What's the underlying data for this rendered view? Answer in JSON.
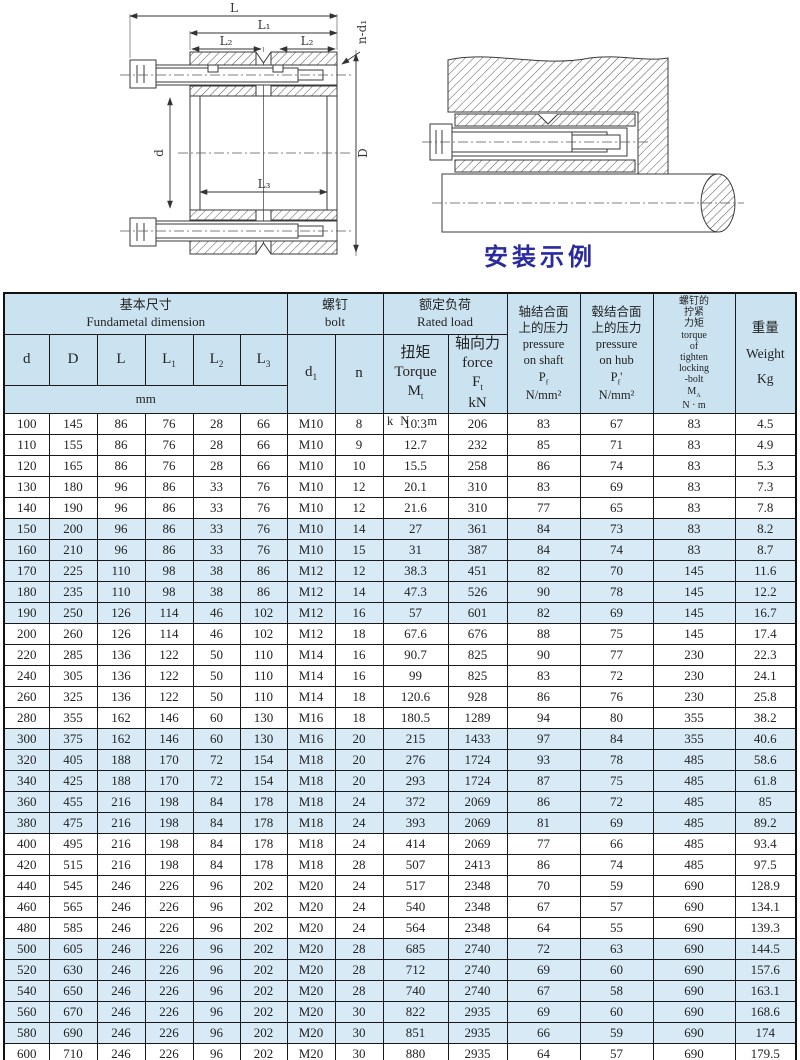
{
  "caption": "安装示例",
  "drawings": {
    "left": {
      "dim_L": "L",
      "dim_L1": "L₁",
      "dim_L2a": "L₂",
      "dim_L2b": "L₂",
      "dim_L3": "L₃",
      "dim_d": "d",
      "dim_D": "D",
      "dim_nd1": "n-d₁"
    }
  },
  "table": {
    "header": {
      "basic": "基本尺寸\nFundametal  dimension",
      "bolt": "螺钉\nbolt",
      "rated": "额定负荷\nRated load",
      "col_d": "d",
      "col_D": "D",
      "col_L": "L",
      "col_L1": "L~1~",
      "col_L2": "L~2~",
      "col_L3": "L~3~",
      "unit_mm": "mm",
      "col_d1": "d~1~",
      "col_n": "n",
      "torque_lines": "扭矩\nTorque\nM~t~",
      "torque_unit": "kN·m",
      "force": "轴向力\nforce\nF~t~\nkN",
      "pressure_shaft": "轴结合面\n上的压力\npressure\non shaft\nP~f~\nN/mm²",
      "pressure_hub": "毂结合面\n上的压力\npressure\non hub\nP~f~'\nN/mm²",
      "ma": "螺钉的\n拧紧\n力矩\ntorque\nof\ntighten\nlocking\n-bolt\nM~A~\nN · m",
      "weight": "重量\nWeight\nKg"
    },
    "rows": [
      [
        100,
        145,
        86,
        76,
        28,
        66,
        "M10",
        8,
        10.3,
        206,
        83,
        67,
        83,
        4.5
      ],
      [
        110,
        155,
        86,
        76,
        28,
        66,
        "M10",
        9,
        12.7,
        232,
        85,
        71,
        83,
        4.9
      ],
      [
        120,
        165,
        86,
        76,
        28,
        66,
        "M10",
        10,
        15.5,
        258,
        86,
        74,
        83,
        5.3
      ],
      [
        130,
        180,
        96,
        86,
        33,
        76,
        "M10",
        12,
        20.1,
        310,
        83,
        69,
        83,
        7.3
      ],
      [
        140,
        190,
        96,
        86,
        33,
        76,
        "M10",
        12,
        21.6,
        310,
        77,
        65,
        83,
        7.8
      ],
      [
        150,
        200,
        96,
        86,
        33,
        76,
        "M10",
        14,
        27,
        361,
        84,
        73,
        83,
        8.2
      ],
      [
        160,
        210,
        96,
        86,
        33,
        76,
        "M10",
        15,
        31,
        387,
        84,
        74,
        83,
        8.7
      ],
      [
        170,
        225,
        110,
        98,
        38,
        86,
        "M12",
        12,
        38.3,
        451,
        82,
        70,
        145,
        11.6
      ],
      [
        180,
        235,
        110,
        98,
        38,
        86,
        "M12",
        14,
        47.3,
        526,
        90,
        78,
        145,
        12.2
      ],
      [
        190,
        250,
        126,
        114,
        46,
        102,
        "M12",
        16,
        57,
        601,
        82,
        69,
        145,
        16.7
      ],
      [
        200,
        260,
        126,
        114,
        46,
        102,
        "M12",
        18,
        67.6,
        676,
        88,
        75,
        145,
        17.4
      ],
      [
        220,
        285,
        136,
        122,
        50,
        110,
        "M14",
        16,
        90.7,
        825,
        90,
        77,
        230,
        22.3
      ],
      [
        240,
        305,
        136,
        122,
        50,
        110,
        "M14",
        16,
        99,
        825,
        83,
        72,
        230,
        24.1
      ],
      [
        260,
        325,
        136,
        122,
        50,
        110,
        "M14",
        18,
        120.6,
        928,
        86,
        76,
        230,
        25.8
      ],
      [
        280,
        355,
        162,
        146,
        60,
        130,
        "M16",
        18,
        180.5,
        1289,
        94,
        80,
        355,
        38.2
      ],
      [
        300,
        375,
        162,
        146,
        60,
        130,
        "M16",
        20,
        215,
        1433,
        97,
        84,
        355,
        40.6
      ],
      [
        320,
        405,
        188,
        170,
        72,
        154,
        "M18",
        20,
        276,
        1724,
        93,
        78,
        485,
        58.6
      ],
      [
        340,
        425,
        188,
        170,
        72,
        154,
        "M18",
        20,
        293,
        1724,
        87,
        75,
        485,
        61.8
      ],
      [
        360,
        455,
        216,
        198,
        84,
        178,
        "M18",
        24,
        372,
        2069,
        86,
        72,
        485,
        85
      ],
      [
        380,
        475,
        216,
        198,
        84,
        178,
        "M18",
        24,
        393,
        2069,
        81,
        69,
        485,
        89.2
      ],
      [
        400,
        495,
        216,
        198,
        84,
        178,
        "M18",
        24,
        414,
        2069,
        77,
        66,
        485,
        93.4
      ],
      [
        420,
        515,
        216,
        198,
        84,
        178,
        "M18",
        28,
        507,
        2413,
        86,
        74,
        485,
        97.5
      ],
      [
        440,
        545,
        246,
        226,
        96,
        202,
        "M20",
        24,
        517,
        2348,
        70,
        59,
        690,
        128.9
      ],
      [
        460,
        565,
        246,
        226,
        96,
        202,
        "M20",
        24,
        540,
        2348,
        67,
        57,
        690,
        134.1
      ],
      [
        480,
        585,
        246,
        226,
        96,
        202,
        "M20",
        24,
        564,
        2348,
        64,
        55,
        690,
        139.3
      ],
      [
        500,
        605,
        246,
        226,
        96,
        202,
        "M20",
        28,
        685,
        2740,
        72,
        63,
        690,
        144.5
      ],
      [
        520,
        630,
        246,
        226,
        96,
        202,
        "M20",
        28,
        712,
        2740,
        69,
        60,
        690,
        157.6
      ],
      [
        540,
        650,
        246,
        226,
        96,
        202,
        "M20",
        28,
        740,
        2740,
        67,
        58,
        690,
        163.1
      ],
      [
        560,
        670,
        246,
        226,
        96,
        202,
        "M20",
        30,
        822,
        2935,
        69,
        60,
        690,
        168.6
      ],
      [
        580,
        690,
        246,
        226,
        96,
        202,
        "M20",
        30,
        851,
        2935,
        66,
        59,
        690,
        174
      ],
      [
        600,
        710,
        246,
        226,
        96,
        202,
        "M20",
        30,
        880,
        2935,
        64,
        57,
        690,
        179.5
      ]
    ],
    "shaded_rows": [
      5,
      6,
      7,
      8,
      9,
      15,
      16,
      17,
      18,
      19,
      25,
      26,
      27,
      28,
      29
    ]
  }
}
